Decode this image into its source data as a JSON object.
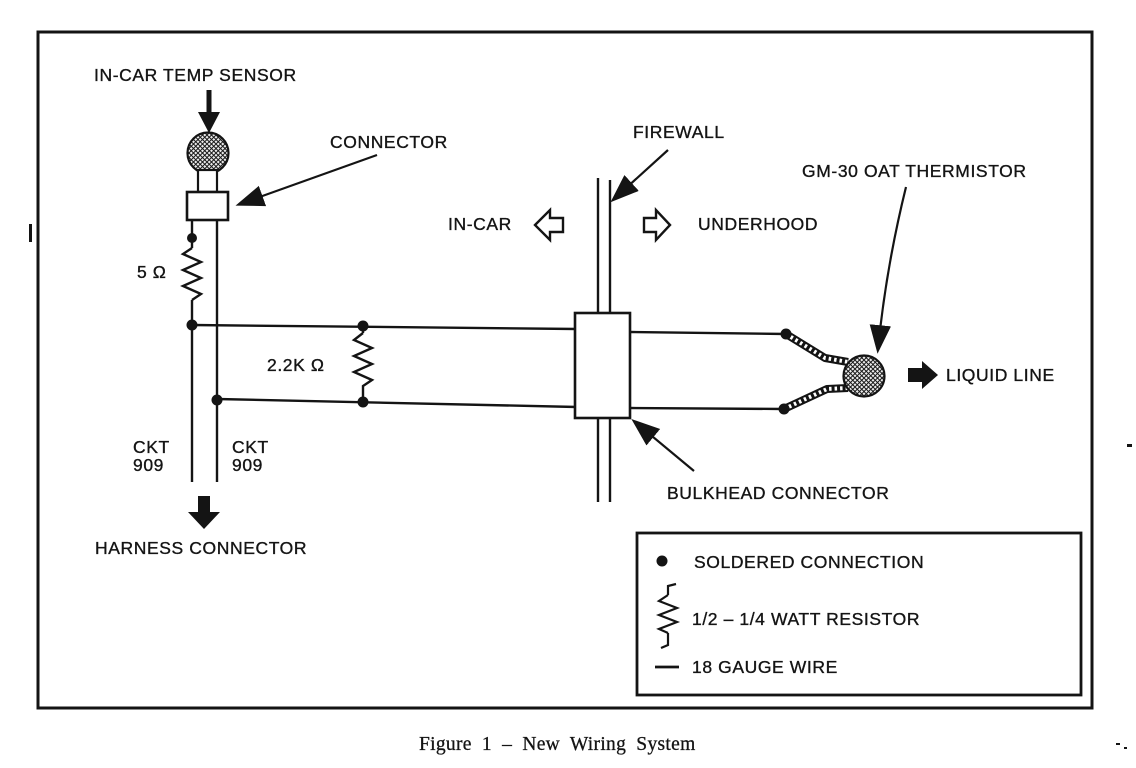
{
  "diagram": {
    "labels": {
      "in_car_temp_sensor": "IN-CAR TEMP SENSOR",
      "connector": "CONNECTOR",
      "firewall": "FIREWALL",
      "in_car": "IN-CAR",
      "underhood": "UNDERHOOD",
      "gm30_oat_thermistor": "GM-30 OAT THERMISTOR",
      "liquid_line": "LIQUID LINE",
      "resistor_5_ohm": "5 Ω",
      "resistor_2_2k_ohm": "2.2K Ω",
      "ckt_909_left": "CKT\n909",
      "ckt_909_right": "CKT\n909",
      "harness_connector": "HARNESS CONNECTOR",
      "bulkhead_connector": "BULKHEAD CONNECTOR"
    },
    "legend": {
      "soldered_connection": "SOLDERED CONNECTION",
      "watt_resistor": "1/2 – 1/4 WATT RESISTOR",
      "gauge_wire": "18 GAUGE WIRE"
    },
    "caption": "Figure 1 – New Wiring System",
    "colors": {
      "ink": "#141414",
      "paper": "#ffffff"
    }
  }
}
